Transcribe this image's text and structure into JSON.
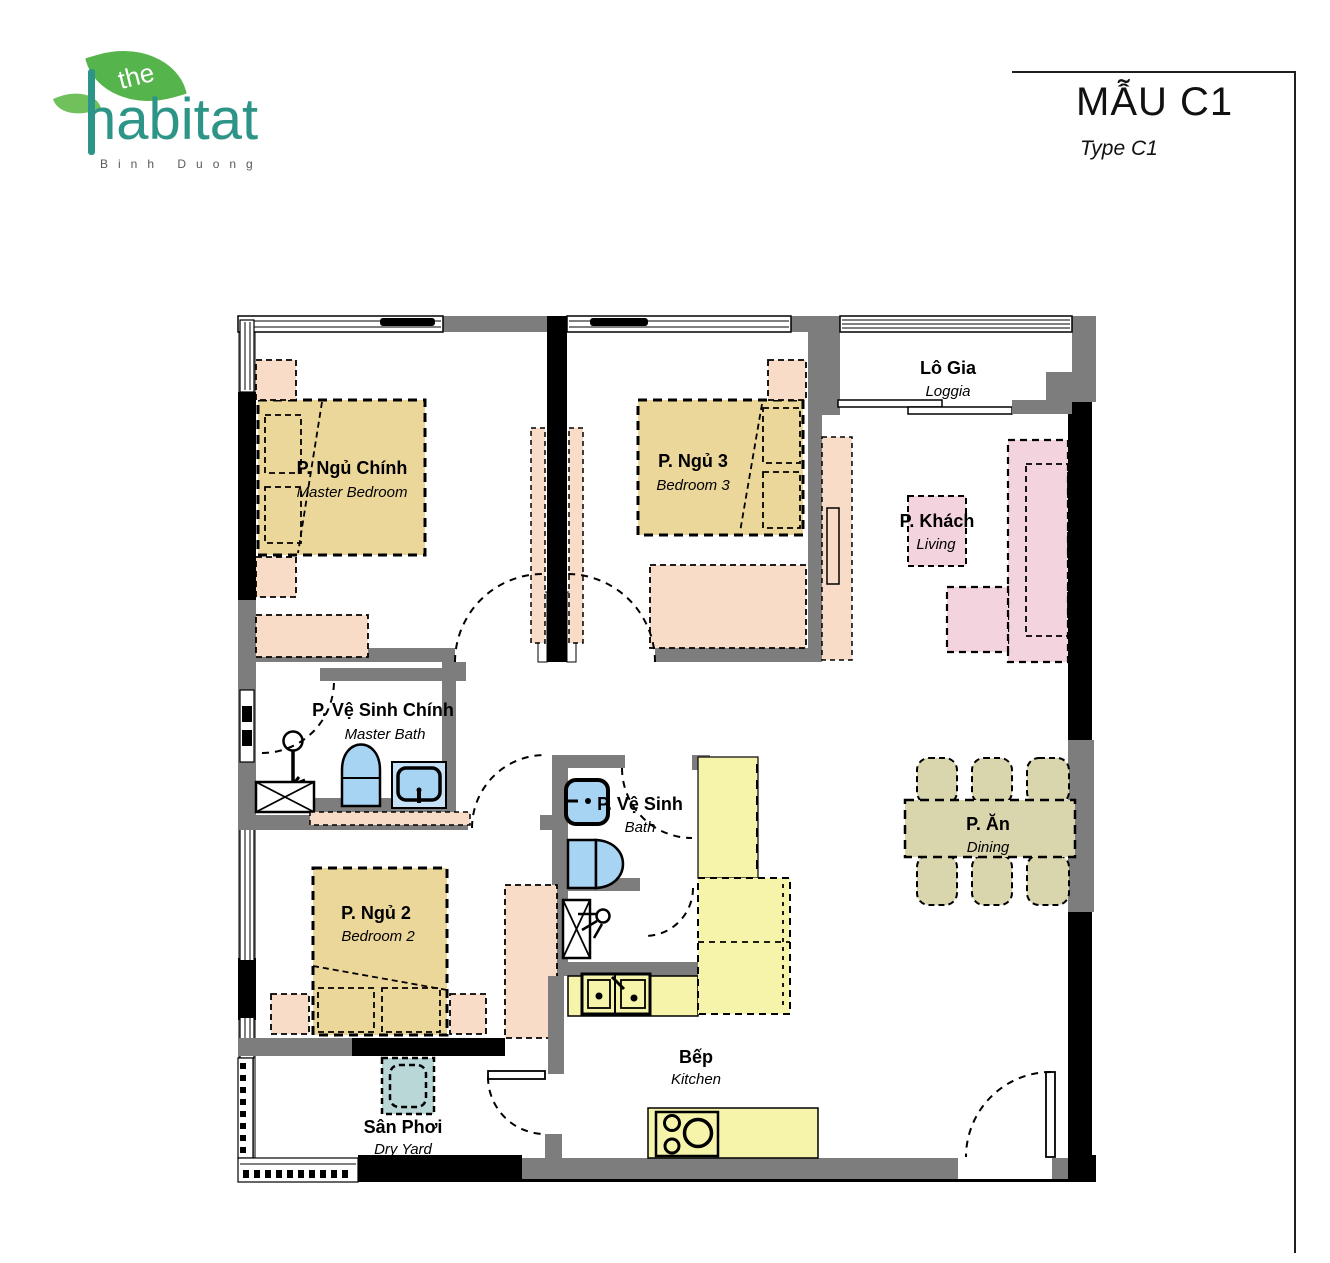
{
  "logo": {
    "prefix": "the",
    "brand": "habitat",
    "location": "Binh Duong"
  },
  "title": {
    "name": "MẪU C1",
    "subtitle": "Type C1"
  },
  "rooms": {
    "master_bedroom": {
      "vi": "P. Ngủ Chính",
      "en": "Master Bedroom"
    },
    "bedroom3": {
      "vi": "P. Ngủ 3",
      "en": "Bedroom 3"
    },
    "loggia": {
      "vi": "Lô Gia",
      "en": "Loggia"
    },
    "living": {
      "vi": "P. Khách",
      "en": "Living"
    },
    "master_bath": {
      "vi": "P. Vệ Sinh Chính",
      "en": "Master Bath"
    },
    "bath": {
      "vi": "P. Vệ Sinh",
      "en": "Bath"
    },
    "bedroom2": {
      "vi": "P. Ngủ 2",
      "en": "Bedroom 2"
    },
    "dining": {
      "vi": "P. Ăn",
      "en": "Dining"
    },
    "kitchen": {
      "vi": "Bếp",
      "en": "Kitchen"
    },
    "dry_yard": {
      "vi": "Sân Phơi",
      "en": "Dry Yard"
    }
  },
  "colors": {
    "wall_gray": "#7d7d7d",
    "wall_black": "#000000",
    "bed_tan": "#ecd79b",
    "furniture_salmon": "#f9dcc8",
    "sofa_pink": "#f3d3de",
    "dining_olive": "#d9d5ad",
    "kitchen_yellow": "#f6f4ab",
    "fixture_blue": "#a8d4f4",
    "washer_teal": "#b9d7d6",
    "brand_teal": "#2d9488",
    "leaf_green": "#55b44b"
  }
}
